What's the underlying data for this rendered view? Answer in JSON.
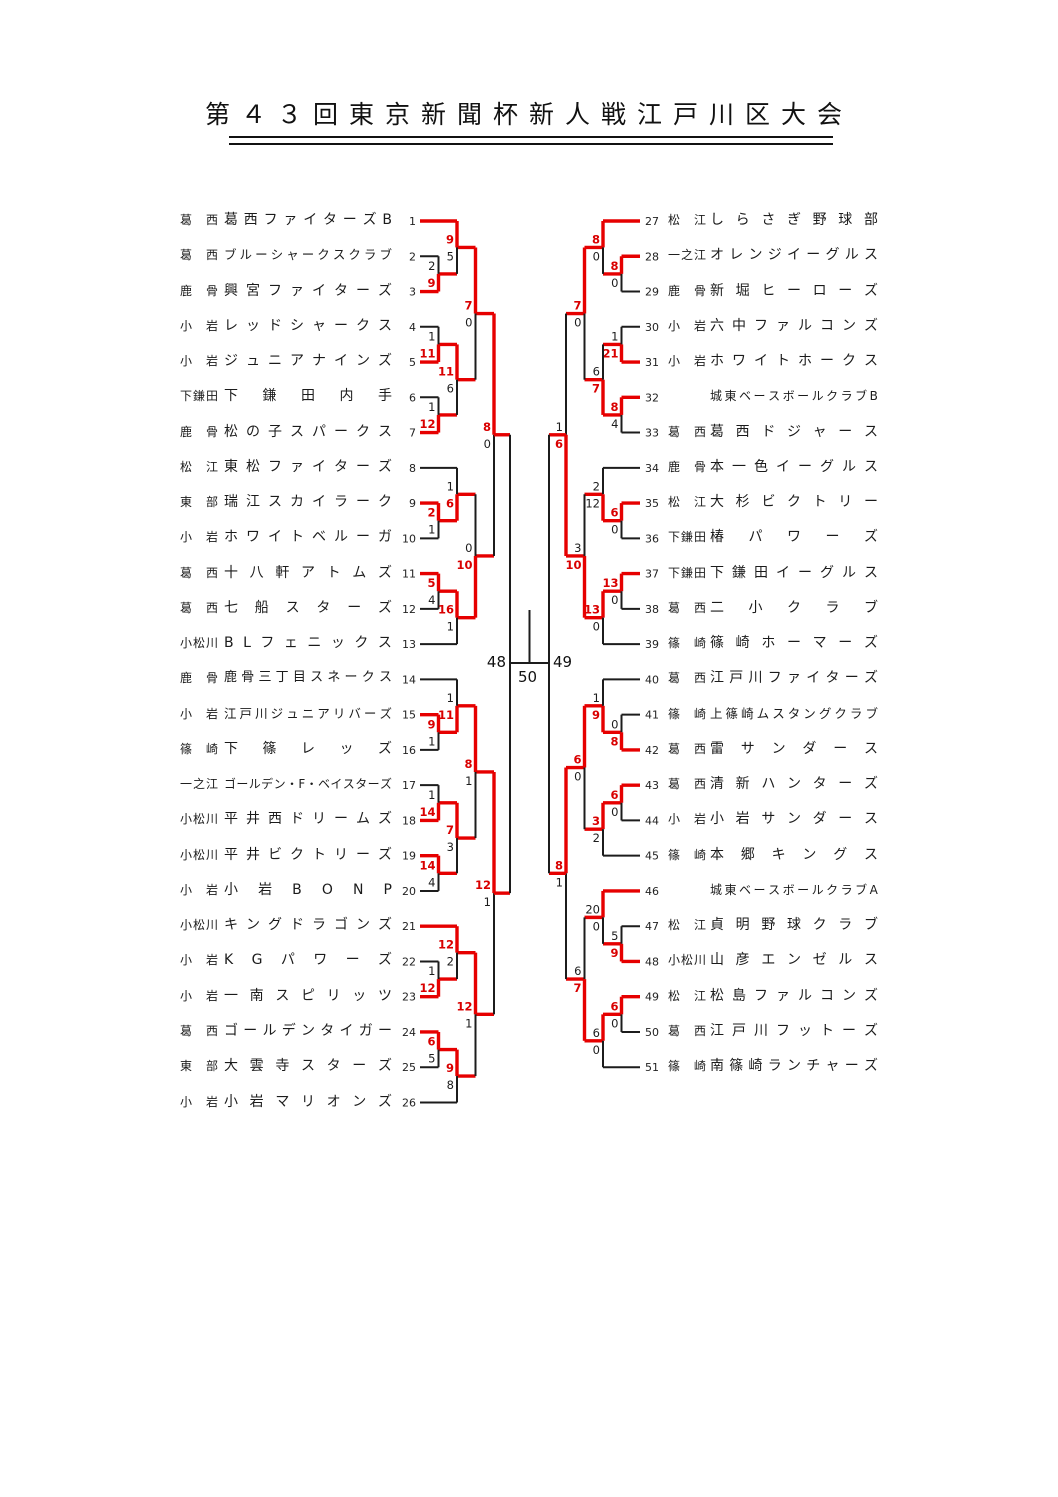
{
  "title": "第４３回東京新聞杯新人戦江戸川区大会",
  "colors": {
    "win_line": "#e60000",
    "line": "#1c1c1c",
    "win_score": "#d90000",
    "score": "#1c1c1c"
  },
  "finals": {
    "left_game_label": "48",
    "right_game_label": "49",
    "final_game_label": "50"
  },
  "teams": [
    {
      "seed": 1,
      "district": "葛西",
      "name": "葛西ファイターズB"
    },
    {
      "seed": 2,
      "district": "葛西",
      "name": "ブルーシャークスクラブ"
    },
    {
      "seed": 3,
      "district": "鹿骨",
      "name": "興宮ファイターズ"
    },
    {
      "seed": 4,
      "district": "小岩",
      "name": "レッドシャークス"
    },
    {
      "seed": 5,
      "district": "小岩",
      "name": "ジュニアナインズ"
    },
    {
      "seed": 6,
      "district": "下鎌田",
      "name": "下鎌田内手"
    },
    {
      "seed": 7,
      "district": "鹿骨",
      "name": "松の子スパークス"
    },
    {
      "seed": 8,
      "district": "松江",
      "name": "東松ファイターズ"
    },
    {
      "seed": 9,
      "district": "東部",
      "name": "瑞江スカイラーク"
    },
    {
      "seed": 10,
      "district": "小岩",
      "name": "ホワイトベルーガ"
    },
    {
      "seed": 11,
      "district": "葛西",
      "name": "十八軒アトムズ"
    },
    {
      "seed": 12,
      "district": "葛西",
      "name": "七船スターズ"
    },
    {
      "seed": 13,
      "district": "小松川",
      "name": "BLフェニックス"
    },
    {
      "seed": 14,
      "district": "鹿骨",
      "name": "鹿骨三丁目スネークス"
    },
    {
      "seed": 15,
      "district": "小岩",
      "name": "江戸川ジュニアリバーズ"
    },
    {
      "seed": 16,
      "district": "篠崎",
      "name": "下篠レッズ"
    },
    {
      "seed": 17,
      "district": "一之江",
      "name": "ゴールデン・F・ベイスターズ"
    },
    {
      "seed": 18,
      "district": "小松川",
      "name": "平井西ドリームズ"
    },
    {
      "seed": 19,
      "district": "小松川",
      "name": "平井ビクトリーズ"
    },
    {
      "seed": 20,
      "district": "小岩",
      "name": "小岩BONP"
    },
    {
      "seed": 21,
      "district": "小松川",
      "name": "キングドラゴンズ"
    },
    {
      "seed": 22,
      "district": "小岩",
      "name": "KGパワーズ"
    },
    {
      "seed": 23,
      "district": "小岩",
      "name": "一南スピリッツ"
    },
    {
      "seed": 24,
      "district": "葛西",
      "name": "ゴールデンタイガー"
    },
    {
      "seed": 25,
      "district": "東部",
      "name": "大雲寺スターズ"
    },
    {
      "seed": 26,
      "district": "小岩",
      "name": "小岩マリオンズ"
    },
    {
      "seed": 27,
      "district": "松江",
      "name": "しらさぎ野球部"
    },
    {
      "seed": 28,
      "district": "一之江",
      "name": "オレンジイーグルス"
    },
    {
      "seed": 29,
      "district": "鹿骨",
      "name": "新堀ヒーローズ"
    },
    {
      "seed": 30,
      "district": "小岩",
      "name": "六中ファルコンズ"
    },
    {
      "seed": 31,
      "district": "小岩",
      "name": "ホワイトホークス"
    },
    {
      "seed": 32,
      "district": "",
      "name": "城東ベースボールクラブB"
    },
    {
      "seed": 33,
      "district": "葛西",
      "name": "葛西ドジャース"
    },
    {
      "seed": 34,
      "district": "鹿骨",
      "name": "本一色イーグルス"
    },
    {
      "seed": 35,
      "district": "松江",
      "name": "大杉ビクトリー"
    },
    {
      "seed": 36,
      "district": "下鎌田",
      "name": "椿パワーズ"
    },
    {
      "seed": 37,
      "district": "下鎌田",
      "name": "下鎌田イーグルス"
    },
    {
      "seed": 38,
      "district": "葛西",
      "name": "二小クラブ"
    },
    {
      "seed": 39,
      "district": "篠崎",
      "name": "篠崎ホーマーズ"
    },
    {
      "seed": 40,
      "district": "葛西",
      "name": "江戸川ファイターズ"
    },
    {
      "seed": 41,
      "district": "篠崎",
      "name": "上篠崎ムスタングクラブ"
    },
    {
      "seed": 42,
      "district": "葛西",
      "name": "雷サンダース"
    },
    {
      "seed": 43,
      "district": "葛西",
      "name": "清新ハンターズ"
    },
    {
      "seed": 44,
      "district": "小岩",
      "name": "小岩サンダース"
    },
    {
      "seed": 45,
      "district": "篠崎",
      "name": "本郷キングス"
    },
    {
      "seed": 46,
      "district": "",
      "name": "城東ベースボールクラブA"
    },
    {
      "seed": 47,
      "district": "松江",
      "name": "貞明野球クラブ"
    },
    {
      "seed": 48,
      "district": "小松川",
      "name": "山彦エンゼルス"
    },
    {
      "seed": 49,
      "district": "松江",
      "name": "松島ファルコンズ"
    },
    {
      "seed": 50,
      "district": "葛西",
      "name": "江戸川フットーズ"
    },
    {
      "seed": 51,
      "district": "篠崎",
      "name": "南篠崎ランチャーズ"
    }
  ],
  "bracket": {
    "left": {
      "top": {
        "s": [
          "8",
          "0"
        ],
        "w": "top",
        "c": [
          "red",
          "black"
        ],
        "top": {
          "s": [
            "7",
            "0"
          ],
          "w": "top",
          "c": [
            "red",
            "black"
          ],
          "top": {
            "s": [
              "9",
              "5"
            ],
            "w": "top",
            "c": [
              "red",
              "black"
            ],
            "top": {
              "team": 1
            },
            "bottom": {
              "s": [
                "2",
                "9"
              ],
              "w": "bottom",
              "c": [
                "black",
                "red"
              ],
              "top": {
                "team": 2
              },
              "bottom": {
                "team": 3
              }
            }
          },
          "bottom": {
            "s": [
              "11",
              "6"
            ],
            "w": "top",
            "c": [
              "red",
              "black"
            ],
            "top": {
              "s": [
                "1",
                "11"
              ],
              "w": "bottom",
              "c": [
                "black",
                "red"
              ],
              "top": {
                "team": 4
              },
              "bottom": {
                "team": 5
              }
            },
            "bottom": {
              "s": [
                "1",
                "12"
              ],
              "w": "bottom",
              "c": [
                "black",
                "red"
              ],
              "top": {
                "team": 6
              },
              "bottom": {
                "team": 7
              }
            }
          }
        },
        "bottom": {
          "s": [
            "0",
            "10"
          ],
          "w": "bottom",
          "c": [
            "black",
            "red"
          ],
          "top": {
            "s": [
              "1",
              "6"
            ],
            "w": "bottom",
            "c": [
              "black",
              "red"
            ],
            "top": {
              "team": 8
            },
            "bottom": {
              "s": [
                "2",
                "1"
              ],
              "w": "top",
              "c": [
                "red",
                "black"
              ],
              "top": {
                "team": 9
              },
              "bottom": {
                "team": 10
              }
            }
          },
          "bottom": {
            "s": [
              "16",
              "1"
            ],
            "w": "top",
            "c": [
              "red",
              "black"
            ],
            "top": {
              "s": [
                "5",
                "4"
              ],
              "w": "top",
              "c": [
                "red",
                "black"
              ],
              "top": {
                "team": 11
              },
              "bottom": {
                "team": 12
              }
            },
            "bottom": {
              "team": 13
            }
          }
        }
      },
      "bottom": {
        "s": [
          "12",
          "1"
        ],
        "w": "top",
        "c": [
          "red",
          "black"
        ],
        "top": {
          "s": [
            "8",
            "1"
          ],
          "w": "top",
          "c": [
            "red",
            "black"
          ],
          "top": {
            "s": [
              "1",
              "11"
            ],
            "w": "bottom",
            "c": [
              "black",
              "red"
            ],
            "top": {
              "team": 14
            },
            "bottom": {
              "s": [
                "9",
                "1"
              ],
              "w": "top",
              "c": [
                "red",
                "black"
              ],
              "top": {
                "team": 15
              },
              "bottom": {
                "team": 16
              }
            }
          },
          "bottom": {
            "s": [
              "7",
              "3"
            ],
            "w": "top",
            "c": [
              "red",
              "black"
            ],
            "top": {
              "s": [
                "1",
                "14"
              ],
              "w": "bottom",
              "c": [
                "black",
                "red"
              ],
              "top": {
                "team": 17
              },
              "bottom": {
                "team": 18
              }
            },
            "bottom": {
              "s": [
                "14",
                "4"
              ],
              "w": "top",
              "c": [
                "red",
                "black"
              ],
              "top": {
                "team": 19
              },
              "bottom": {
                "team": 20
              }
            }
          }
        },
        "bottom": {
          "s": [
            "12",
            "1"
          ],
          "w": "top",
          "c": [
            "red",
            "black"
          ],
          "top": {
            "s": [
              "12",
              "2"
            ],
            "w": "top",
            "c": [
              "red",
              "black"
            ],
            "top": {
              "team": 21
            },
            "bottom": {
              "s": [
                "1",
                "12"
              ],
              "w": "bottom",
              "c": [
                "black",
                "red"
              ],
              "top": {
                "team": 22
              },
              "bottom": {
                "team": 23
              }
            }
          },
          "bottom": {
            "s": [
              "9",
              "8"
            ],
            "w": "top",
            "c": [
              "red",
              "black"
            ],
            "top": {
              "s": [
                "6",
                "5"
              ],
              "w": "top",
              "c": [
                "red",
                "black"
              ],
              "top": {
                "team": 24
              },
              "bottom": {
                "team": 25
              }
            },
            "bottom": {
              "team": 26
            }
          }
        }
      }
    },
    "right": {
      "top": {
        "s": [
          "1",
          "6"
        ],
        "w": "bottom",
        "c": [
          "black",
          "red"
        ],
        "top": {
          "s": [
            "7",
            "0"
          ],
          "w": "top",
          "c": [
            "red",
            "black"
          ],
          "top": {
            "s": [
              "8",
              "0"
            ],
            "w": "top",
            "c": [
              "red",
              "black"
            ],
            "top": {
              "team": 27
            },
            "bottom": {
              "s": [
                "8",
                "0"
              ],
              "w": "top",
              "c": [
                "red",
                "black"
              ],
              "top": {
                "team": 28
              },
              "bottom": {
                "team": 29
              }
            }
          },
          "bottom": {
            "s": [
              "6",
              "7"
            ],
            "w": "bottom",
            "c": [
              "black",
              "red"
            ],
            "top": {
              "s": [
                "1",
                "21"
              ],
              "w": "bottom",
              "c": [
                "black",
                "red"
              ],
              "top": {
                "team": 30
              },
              "bottom": {
                "team": 31
              }
            },
            "bottom": {
              "s": [
                "8",
                "4"
              ],
              "w": "top",
              "c": [
                "red",
                "black"
              ],
              "top": {
                "team": 32
              },
              "bottom": {
                "team": 33
              }
            }
          }
        },
        "bottom": {
          "s": [
            "3",
            "10"
          ],
          "w": "bottom",
          "c": [
            "black",
            "red"
          ],
          "top": {
            "s": [
              "2",
              "12"
            ],
            "w": "bottom",
            "c": [
              "black",
              "black"
            ],
            "top": {
              "team": 34
            },
            "bottom": {
              "s": [
                "6",
                "0"
              ],
              "w": "top",
              "c": [
                "red",
                "black"
              ],
              "top": {
                "team": 35
              },
              "bottom": {
                "team": 36
              }
            }
          },
          "bottom": {
            "s": [
              "13",
              "0"
            ],
            "w": "top",
            "c": [
              "red",
              "black"
            ],
            "top": {
              "s": [
                "13",
                "0"
              ],
              "w": "top",
              "c": [
                "red",
                "black"
              ],
              "top": {
                "team": 37
              },
              "bottom": {
                "team": 38
              }
            },
            "bottom": {
              "team": 39
            }
          }
        }
      },
      "bottom": {
        "s": [
          "8",
          "1"
        ],
        "w": "top",
        "c": [
          "red",
          "black"
        ],
        "top": {
          "s": [
            "6",
            "0"
          ],
          "w": "top",
          "c": [
            "red",
            "black"
          ],
          "top": {
            "s": [
              "1",
              "9"
            ],
            "w": "bottom",
            "c": [
              "black",
              "red"
            ],
            "top": {
              "team": 40
            },
            "bottom": {
              "s": [
                "0",
                "8"
              ],
              "w": "bottom",
              "c": [
                "black",
                "red"
              ],
              "top": {
                "team": 41
              },
              "bottom": {
                "team": 42
              }
            }
          },
          "bottom": {
            "s": [
              "3",
              "2"
            ],
            "w": "top",
            "c": [
              "red",
              "black"
            ],
            "top": {
              "s": [
                "6",
                "0"
              ],
              "w": "top",
              "c": [
                "red",
                "black"
              ],
              "top": {
                "team": 43
              },
              "bottom": {
                "team": 44
              }
            },
            "bottom": {
              "team": 45
            }
          }
        },
        "bottom": {
          "s": [
            "6",
            "7"
          ],
          "w": "bottom",
          "c": [
            "black",
            "red"
          ],
          "top": {
            "s": [
              "20",
              "0"
            ],
            "w": "top",
            "c": [
              "black",
              "black"
            ],
            "top": {
              "team": 46
            },
            "bottom": {
              "s": [
                "5",
                "9"
              ],
              "w": "bottom",
              "c": [
                "black",
                "red"
              ],
              "top": {
                "team": 47
              },
              "bottom": {
                "team": 48
              }
            }
          },
          "bottom": {
            "s": [
              "6",
              "0"
            ],
            "w": "top",
            "c": [
              "black",
              "black"
            ],
            "top": {
              "s": [
                "6",
                "0"
              ],
              "w": "top",
              "c": [
                "red",
                "black"
              ],
              "top": {
                "team": 49
              },
              "bottom": {
                "team": 50
              }
            },
            "bottom": {
              "team": 51
            }
          }
        }
      }
    }
  }
}
